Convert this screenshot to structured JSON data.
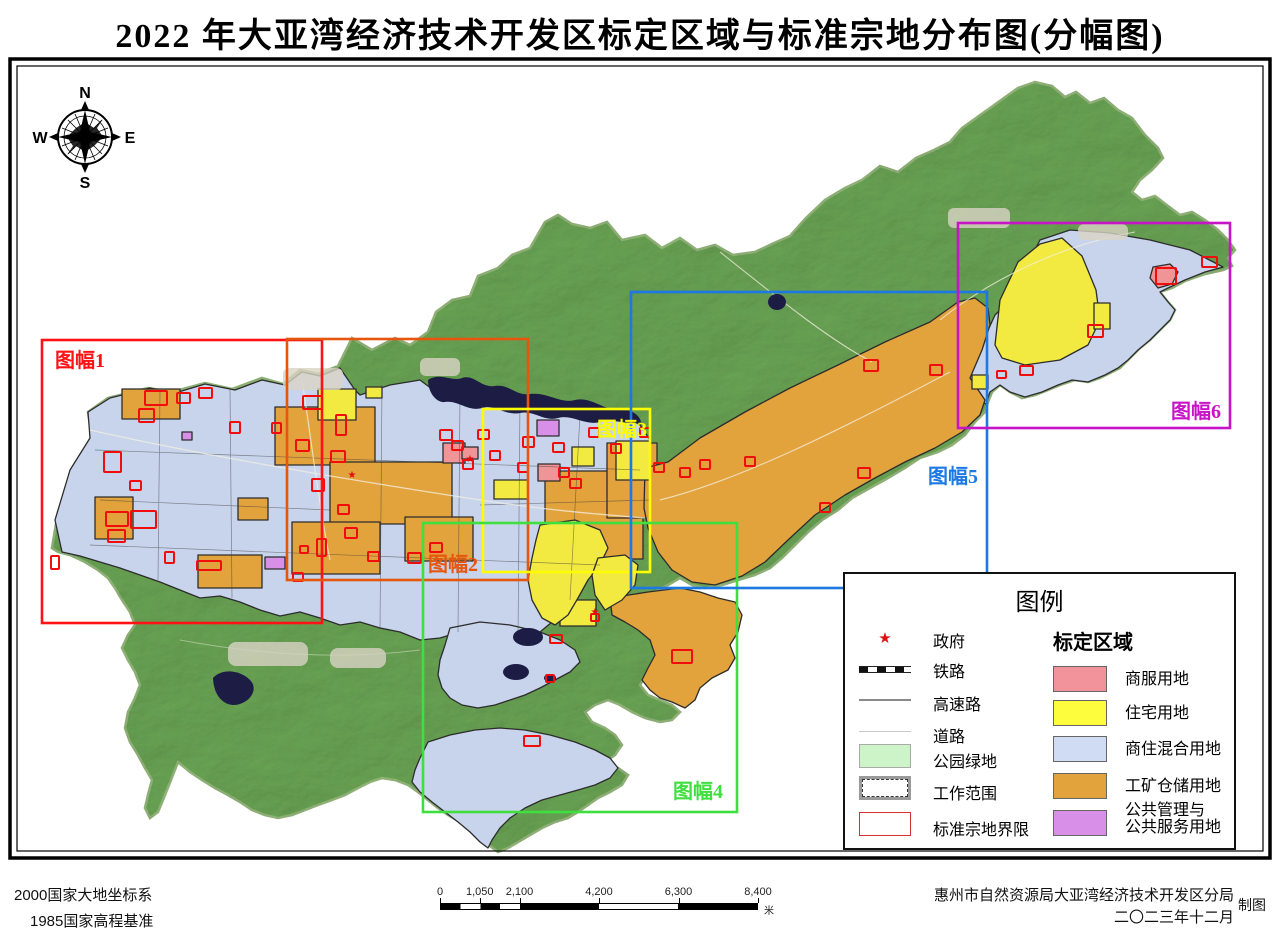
{
  "title": "2022 年大亚湾经济技术开发区标定区域与标准宗地分布图(分幅图)",
  "compass": {
    "n": "N",
    "s": "S",
    "e": "E",
    "w": "W"
  },
  "frames": [
    {
      "id": 1,
      "label": "图幅1",
      "color": "#fe1216",
      "x": 42,
      "y": 340,
      "w": 280,
      "h": 283,
      "lx": 55,
      "ly": 344
    },
    {
      "id": 2,
      "label": "图幅2",
      "color": "#e7560e",
      "x": 287,
      "y": 339,
      "w": 241,
      "h": 241,
      "lx": 428,
      "ly": 548
    },
    {
      "id": 3,
      "label": "图幅3",
      "color": "#fdfd00",
      "x": 483,
      "y": 409,
      "w": 167,
      "h": 163,
      "lx": 597,
      "ly": 413
    },
    {
      "id": 4,
      "label": "图幅4",
      "color": "#3fdf3f",
      "x": 423,
      "y": 523,
      "w": 314,
      "h": 289,
      "lx": 673,
      "ly": 775
    },
    {
      "id": 5,
      "label": "图幅5",
      "color": "#1c79e3",
      "x": 631,
      "y": 292,
      "w": 356,
      "h": 296,
      "lx": 928,
      "ly": 460
    },
    {
      "id": 6,
      "label": "图幅6",
      "color": "#c714c7",
      "x": 958,
      "y": 223,
      "w": 272,
      "h": 205,
      "lx": 1171,
      "ly": 395
    }
  ],
  "legend": {
    "title": "图例",
    "symbol_items": [
      {
        "name": "government",
        "label": "政府",
        "glyph": "★"
      },
      {
        "name": "railway",
        "label": "铁路"
      },
      {
        "name": "highway",
        "label": "高速路"
      },
      {
        "name": "road",
        "label": "道路"
      },
      {
        "name": "park-green",
        "label": "公园绿地",
        "color": "#cdf3c9"
      },
      {
        "name": "work-scope",
        "label": "工作范围"
      },
      {
        "name": "parcel-boundary",
        "label": "标准宗地界限"
      }
    ],
    "zone_header": "标定区域",
    "zone_items": [
      {
        "label": "商服用地",
        "label2": "",
        "color": "#f2939b"
      },
      {
        "label": "住宅用地",
        "label2": "",
        "color": "#fdfd3d"
      },
      {
        "label": "商住混合用地",
        "label2": "",
        "color": "#cfdcf3"
      },
      {
        "label": "工矿仓储用地",
        "label2": "",
        "color": "#e2a23c"
      },
      {
        "label": "公共管理与",
        "label2": "公共服务用地",
        "color": "#d88fe8"
      }
    ]
  },
  "scalebar": {
    "labels": [
      "0",
      "1,050",
      "2,100",
      "4,200",
      "6,300",
      "8,400"
    ],
    "positions_pct": [
      0,
      12.5,
      25,
      50,
      75,
      100
    ],
    "unit": "米"
  },
  "footer": {
    "datum1": "2000国家大地坐标系",
    "datum2": "1985国家高程基准",
    "org": "惠州市自然资源局大亚湾经济技术开发区分局",
    "date": "二〇二三年十二月",
    "credit": "制图"
  },
  "map": {
    "parcel_color": "#f20d0d",
    "parcels": [
      [
        145,
        391,
        22,
        14
      ],
      [
        177,
        393,
        13,
        10
      ],
      [
        199,
        388,
        13,
        10
      ],
      [
        139,
        409,
        15,
        13
      ],
      [
        230,
        422,
        10,
        11
      ],
      [
        272,
        423,
        9,
        10
      ],
      [
        104,
        452,
        17,
        20
      ],
      [
        130,
        481,
        11,
        9
      ],
      [
        106,
        512,
        22,
        14
      ],
      [
        131,
        511,
        25,
        17
      ],
      [
        108,
        530,
        17,
        12
      ],
      [
        51,
        556,
        8,
        13
      ],
      [
        165,
        552,
        9,
        11
      ],
      [
        197,
        561,
        24,
        9
      ],
      [
        300,
        546,
        8,
        7
      ],
      [
        317,
        539,
        9,
        17
      ],
      [
        303,
        396,
        19,
        13
      ],
      [
        336,
        415,
        10,
        20
      ],
      [
        296,
        440,
        13,
        11
      ],
      [
        331,
        451,
        14,
        11
      ],
      [
        312,
        479,
        12,
        12
      ],
      [
        338,
        505,
        11,
        9
      ],
      [
        345,
        528,
        12,
        10
      ],
      [
        368,
        552,
        11,
        9
      ],
      [
        408,
        553,
        13,
        10
      ],
      [
        430,
        543,
        12,
        9
      ],
      [
        440,
        430,
        12,
        10
      ],
      [
        452,
        441,
        11,
        9
      ],
      [
        463,
        460,
        10,
        9
      ],
      [
        478,
        430,
        11,
        9
      ],
      [
        490,
        451,
        10,
        9
      ],
      [
        523,
        437,
        11,
        10
      ],
      [
        518,
        463,
        10,
        9
      ],
      [
        553,
        443,
        11,
        9
      ],
      [
        559,
        468,
        10,
        9
      ],
      [
        589,
        428,
        10,
        9
      ],
      [
        570,
        479,
        11,
        9
      ],
      [
        611,
        444,
        10,
        9
      ],
      [
        640,
        428,
        10,
        9
      ],
      [
        654,
        463,
        10,
        9
      ],
      [
        680,
        468,
        10,
        9
      ],
      [
        700,
        460,
        10,
        9
      ],
      [
        745,
        457,
        10,
        9
      ],
      [
        820,
        503,
        10,
        9
      ],
      [
        858,
        468,
        12,
        10
      ],
      [
        864,
        360,
        14,
        11
      ],
      [
        930,
        365,
        12,
        10
      ],
      [
        550,
        635,
        12,
        8
      ],
      [
        672,
        650,
        20,
        13
      ],
      [
        524,
        736,
        16,
        10
      ],
      [
        293,
        573,
        10,
        8
      ],
      [
        1202,
        257,
        15,
        10
      ],
      [
        1156,
        268,
        20,
        16
      ],
      [
        1088,
        325,
        15,
        12
      ],
      [
        1020,
        366,
        13,
        9
      ],
      [
        997,
        371,
        9,
        7
      ],
      [
        591,
        614,
        8,
        7
      ],
      [
        546,
        675,
        8,
        7
      ]
    ],
    "star_color": "#e01010",
    "stars": [
      [
        352,
        478
      ],
      [
        470,
        462
      ],
      [
        595,
        615
      ]
    ]
  }
}
